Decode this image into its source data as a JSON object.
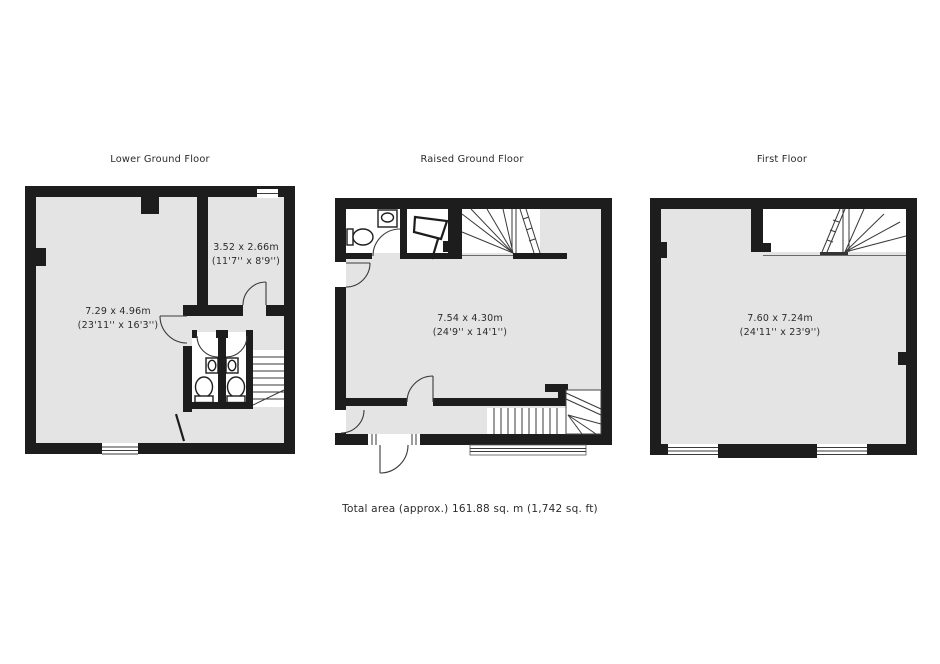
{
  "document": {
    "type": "floorplan",
    "background": "#ffffff",
    "colors": {
      "wall": "#1d1d1d",
      "room_fill": "#e4e4e4",
      "line": "#3a3a3a",
      "text": "#2b2b2b"
    }
  },
  "floors": [
    {
      "title": "Lower Ground Floor",
      "rooms": [
        {
          "dim_m": "7.29 x 4.96m",
          "dim_ft": "(23'11'' x 16'3'')"
        },
        {
          "dim_m": "3.52 x 2.66m",
          "dim_ft": "(11'7'' x 8'9'')"
        }
      ]
    },
    {
      "title": "Raised Ground Floor",
      "rooms": [
        {
          "dim_m": "7.54 x 4.30m",
          "dim_ft": "(24'9'' x 14'1'')"
        }
      ]
    },
    {
      "title": "First Floor",
      "rooms": [
        {
          "dim_m": "7.60 x 7.24m",
          "dim_ft": "(24'11'' x 23'9'')"
        }
      ]
    }
  ],
  "footer": {
    "total_area": "Total area (approx.) 161.88 sq. m (1,742 sq. ft)"
  }
}
